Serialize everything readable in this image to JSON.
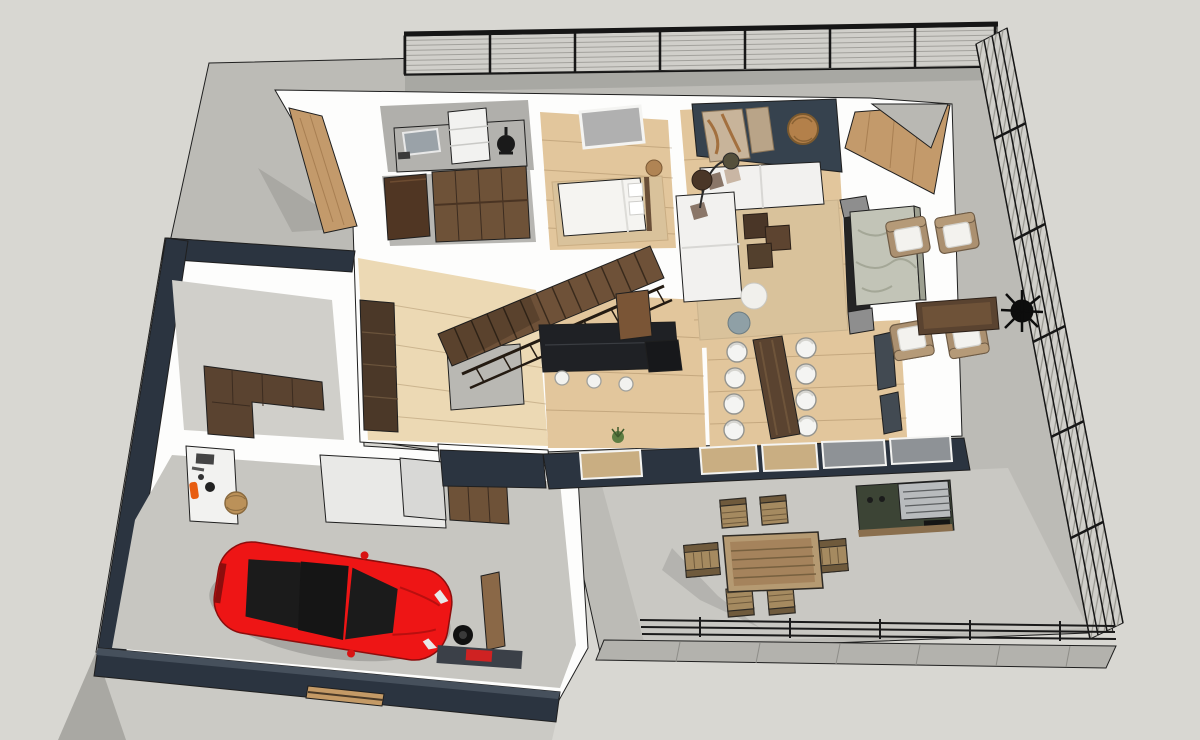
{
  "scene": {
    "type": "3d-floorplan-render",
    "style": "sketchup-axonometric-cutaway",
    "view": "top-down oblique",
    "storeys_visible": 1,
    "width": 1200,
    "height": 740
  },
  "colors": {
    "background": "#d8d7d2",
    "yard_concrete": "#bcbbb6",
    "patio_concrete": "#c9c8c3",
    "driveway": "#cbcac5",
    "ground_shadow": "#a9a8a3",
    "wall_white": "#fdfdfc",
    "wall_navy": "#2b3440",
    "wall_navy_light": "#46505c",
    "wall_navy_side": "#323b47",
    "accent_wall": "#36424e",
    "wood_floor": "#e2c69c",
    "hall_floor": "#ecd9b4",
    "wood_wall": "#c39a6b",
    "dark_wood": "#5a4330",
    "mid_wood": "#6e5238",
    "stair_wood": "#6e5138",
    "car_red": "#ee1515",
    "car_glass": "#1b1b1b",
    "sofa_white": "#f2f1ef",
    "rug_beige": "#d9c29b",
    "stone_fireplace": "#c2c4b7",
    "stone_side": "#9da091",
    "wicker": "#ab9070",
    "cushion_white": "#f3f2ee",
    "outdoor_table_wood": "#b59a72",
    "outdoor_chair_wood": "#a58a60",
    "bbq_green": "#3c4435",
    "bbq_steel": "#b8bbbd",
    "plant_black": "#0d0d0d",
    "plant_green": "#5d7d42",
    "fence_slat": "#d0cfca",
    "fence_frame": "#171717",
    "glass_tan": "#c9ae82",
    "glass_gray": "#8e9296",
    "extinguisher_orange": "#e85d10",
    "toolbox_red": "#cf2222",
    "basket_tan": "#bb9159",
    "garage_floor": "#c7c6c1",
    "mudroom_floor": "#d0cfca",
    "counter_gray": "#b3b2ae",
    "cabinet_white": "#e9e9e7"
  },
  "inventory": {
    "rooms": [
      {
        "name": "garage",
        "objects": [
          "sports-car",
          "workbench",
          "fire-extinguisher",
          "storage-basket",
          "spare-tire",
          "toolbox",
          "leaning-board",
          "floor-mat",
          "window-slits",
          "garage-door"
        ]
      },
      {
        "name": "mudroom-pantry",
        "objects": [
          "pantry-cabinets"
        ]
      },
      {
        "name": "laundry-room",
        "objects": [
          "counter",
          "mirror",
          "washer-cabinet",
          "wall-clock"
        ]
      },
      {
        "name": "walk-in-closet",
        "objects": [
          "wardrobe-cabinets",
          "door"
        ]
      },
      {
        "name": "bedroom",
        "objects": [
          "double-bed",
          "pillows",
          "side-table",
          "rug",
          "window"
        ]
      },
      {
        "name": "hallway",
        "objects": [
          "staircase",
          "stair-railing",
          "bookshelf",
          "half-wall"
        ]
      },
      {
        "name": "kitchen",
        "objects": [
          "island-counter",
          "bar-stools",
          "tall-appliance",
          "base-cabinets",
          "refrigerator",
          "open-door",
          "small-plant"
        ]
      },
      {
        "name": "dining-room",
        "objects": [
          "dining-table",
          "dining-chairs"
        ]
      },
      {
        "name": "living-room",
        "objects": [
          "accent-wall",
          "wall-art",
          "round-wood-decor",
          "arc-lamp",
          "sectional-sofa",
          "cube-coffee-tables",
          "pouf-white",
          "pouf-gray",
          "rug",
          "media-wall",
          "tv"
        ]
      },
      {
        "name": "fireplace",
        "objects": [
          "stone-column"
        ]
      },
      {
        "name": "terrace-lounge",
        "objects": [
          "lounge-chairs",
          "coffee-table",
          "black-plant"
        ]
      },
      {
        "name": "patio",
        "objects": [
          "outdoor-dining-table",
          "outdoor-dining-chairs",
          "bbq-grill"
        ]
      },
      {
        "name": "yard",
        "objects": [
          "slat-fence-top",
          "slat-fence-right",
          "low-fence",
          "paver-strip",
          "driveway"
        ]
      }
    ],
    "counts": {
      "dining_chairs": 8,
      "bar_stools": 3,
      "lounge_chairs": 4,
      "outdoor_dining_chairs": 6,
      "stair_treads": 13,
      "garage_window_slits": 5,
      "facade_glass_panes": 4,
      "cube_tables": 3,
      "wall_art_pieces": 2
    }
  }
}
